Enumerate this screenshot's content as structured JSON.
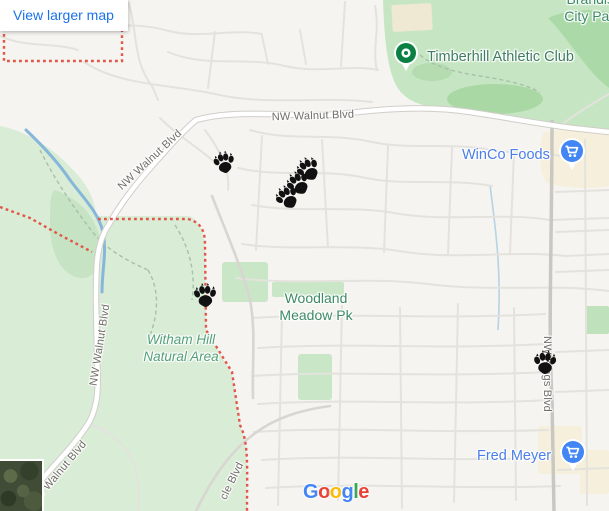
{
  "embed": {
    "view_larger_map": "View larger map",
    "logo_letters": [
      "G",
      "o",
      "o",
      "g",
      "l",
      "e"
    ],
    "logo_styles": [
      "color:#4285F4",
      "color:#EA4335",
      "color:#FBBC05",
      "color:#4285F4",
      "color:#34A853",
      "color:#EA4335"
    ]
  },
  "labels": {
    "roads": {
      "walnut": "NW Walnut Blvd",
      "kings": "NW Kings Blvd",
      "circle_partial": "cle Blvd"
    },
    "places": {
      "brandis": {
        "line1": "Brandis",
        "line2": "City Par"
      },
      "timberhill": {
        "name": "Timberhill Athletic Club"
      },
      "winco": {
        "name": "WinCo Foods"
      },
      "fred_meyer": {
        "name": "Fred Meyer"
      },
      "woodland": {
        "line1": "Woodland",
        "line2": "Meadow Pk"
      },
      "witham": {
        "line1": "Witham Hill",
        "line2": "Natural Area"
      }
    }
  },
  "markers": {
    "type": "paw-print",
    "count": 6,
    "paws": [
      {
        "x": 224,
        "y": 162,
        "rot": -12,
        "size": 25
      },
      {
        "x": 287,
        "y": 197,
        "rot": -33,
        "size": 27
      },
      {
        "x": 298,
        "y": 183,
        "rot": -33,
        "size": 27
      },
      {
        "x": 308,
        "y": 169,
        "rot": -33,
        "size": 27
      },
      {
        "x": 205,
        "y": 295,
        "rot": -4,
        "size": 27
      },
      {
        "x": 545,
        "y": 362,
        "rot": 0,
        "size": 27
      }
    ]
  },
  "colors": {
    "link_blue": "#1a73e8",
    "poi_text_blue": "#4a7ee8",
    "poi_pin_blue": "#4285f4",
    "poi_pin_green": "#0b8043",
    "park_fill": "#c6e6c3",
    "natural_fill": "#d9ecd6",
    "park_label_green": "#3d8b66",
    "natural_label_green": "#53a078",
    "boundary_red": "#e25649",
    "water_blue": "#86b7da",
    "commercial_tan": "#f6efdb",
    "road_label_gray": "#6f6d68",
    "paw_black": "#111111"
  }
}
